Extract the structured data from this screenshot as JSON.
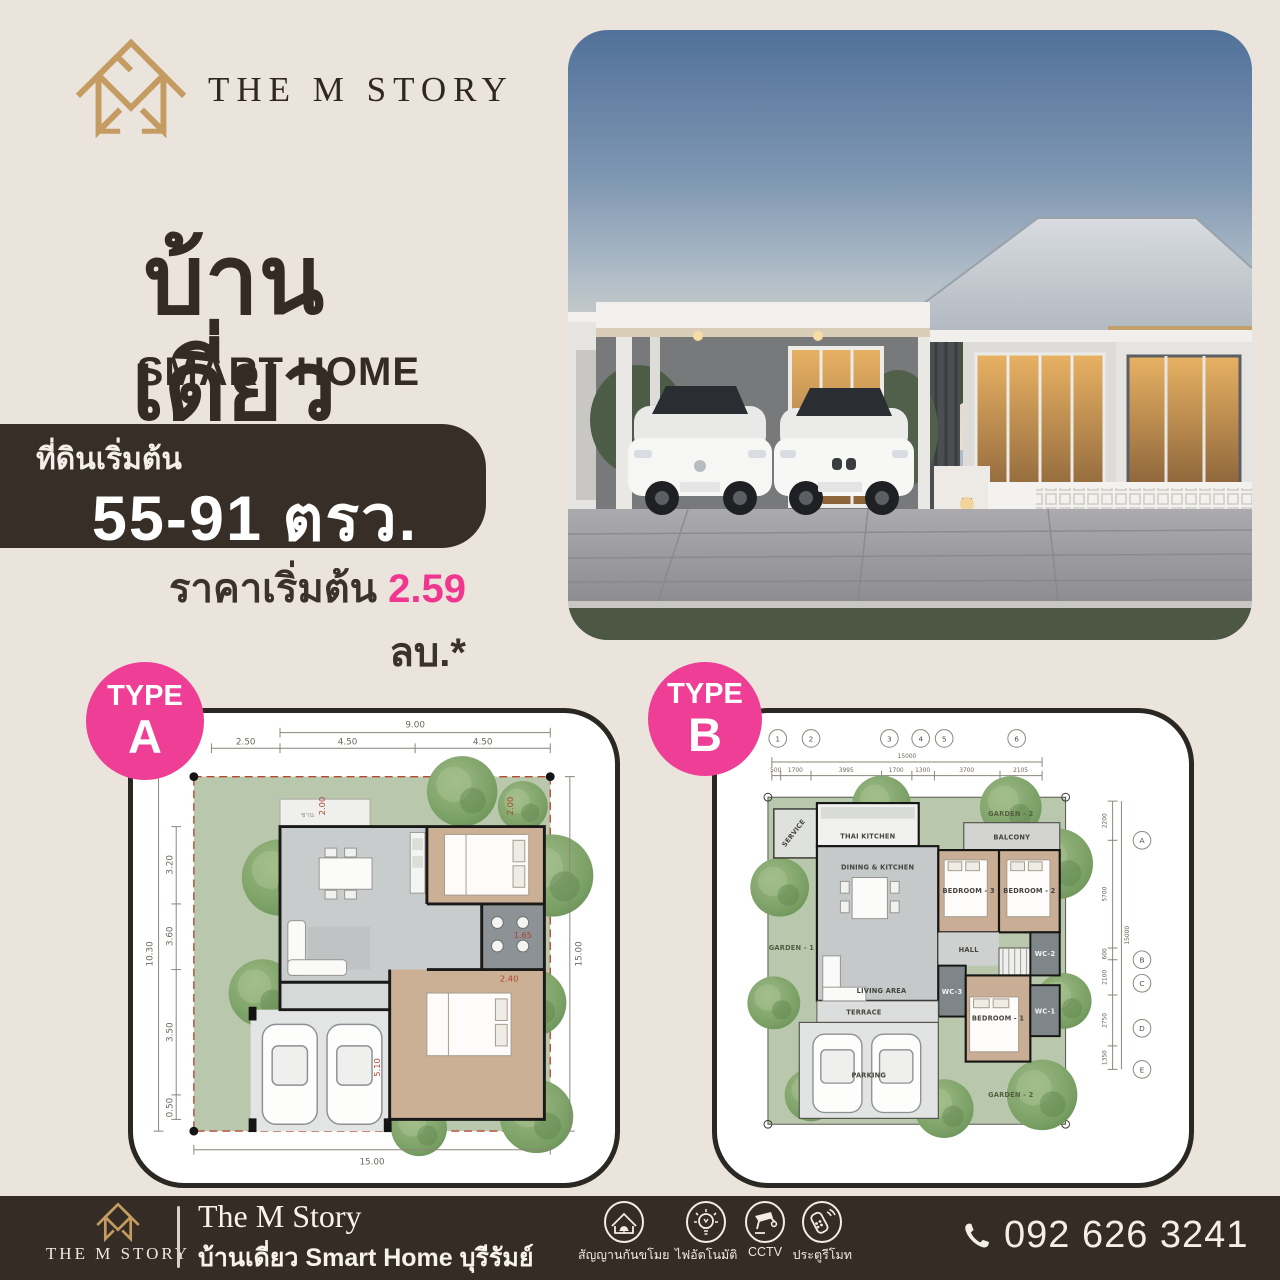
{
  "header": {
    "brand": "THE M STORY"
  },
  "hero": {
    "title": "บ้านเดี่ยว",
    "subtitle": "SMART HOME",
    "land_label": "ที่ดินเริ่มต้น",
    "land_value": "55-91 ตรว.",
    "price_label": "ราคาเริ่มต้น ",
    "price_value": "2.59",
    "price_unit": " ลบ.*"
  },
  "colors": {
    "accent_pink": "#EE3E96",
    "price_pink": "#F0368F",
    "gold": "#C49B60",
    "dark_brown": "#372E27"
  },
  "plans": {
    "a": {
      "badge_top": "TYPE",
      "badge_letter": "A",
      "porch": "ชาน",
      "dims": {
        "top_total": "9.00",
        "top_segments": [
          "2.50",
          "4.50",
          "4.50"
        ],
        "left_total": "10.30",
        "left_segments": [
          "3.20",
          "3.60",
          "3.50",
          "0.50"
        ],
        "right_total": "15.00",
        "bottom_total": "15.00",
        "red": [
          "2.00",
          "2.00",
          "1.65",
          "2.40",
          "5.10"
        ]
      }
    },
    "b": {
      "badge_top": "TYPE",
      "badge_letter": "B",
      "grid_cols": [
        "1",
        "2",
        "3",
        "4",
        "5",
        "6"
      ],
      "grid_rows": [
        "A",
        "B",
        "C",
        "D",
        "E"
      ],
      "dims": {
        "top_total": "15000",
        "top_segments": [
          "500",
          "1700",
          "3995",
          "1700",
          "1300",
          "3700",
          "2105"
        ],
        "right_total": "15000",
        "right_segments": [
          "2200",
          "5700",
          "600",
          "2100",
          "2750",
          "1350"
        ]
      },
      "rooms": {
        "service": "SERVICE",
        "thai_kitchen": "THAI KITCHEN",
        "dining": "DINING & KITCHEN",
        "garden1": "GARDEN - 1",
        "garden2_top": "GARDEN - 2",
        "balcony": "BALCONY",
        "bed3": "BEDROOM - 3",
        "bed2": "BEDROOM - 2",
        "hall": "HALL",
        "living": "LIVING AREA",
        "wc3": "WC-3",
        "wc2": "WC-2",
        "wc1": "WC-1",
        "bed1": "BEDROOM - 1",
        "terrace": "TERRACE",
        "parking": "PARKING",
        "garden2_bottom": "GARDEN - 2"
      }
    }
  },
  "footer": {
    "brand": "THE M STORY",
    "title": "The M Story",
    "subtitle": "บ้านเดี่ยว Smart Home บุรีรัมย์",
    "features": [
      {
        "label": "สัญญานกันขโมย"
      },
      {
        "label": "ไฟอัตโนมัติ"
      },
      {
        "label": "CCTV"
      },
      {
        "label": "ประตูรีโมท"
      }
    ],
    "phone": "092 626 3241"
  }
}
